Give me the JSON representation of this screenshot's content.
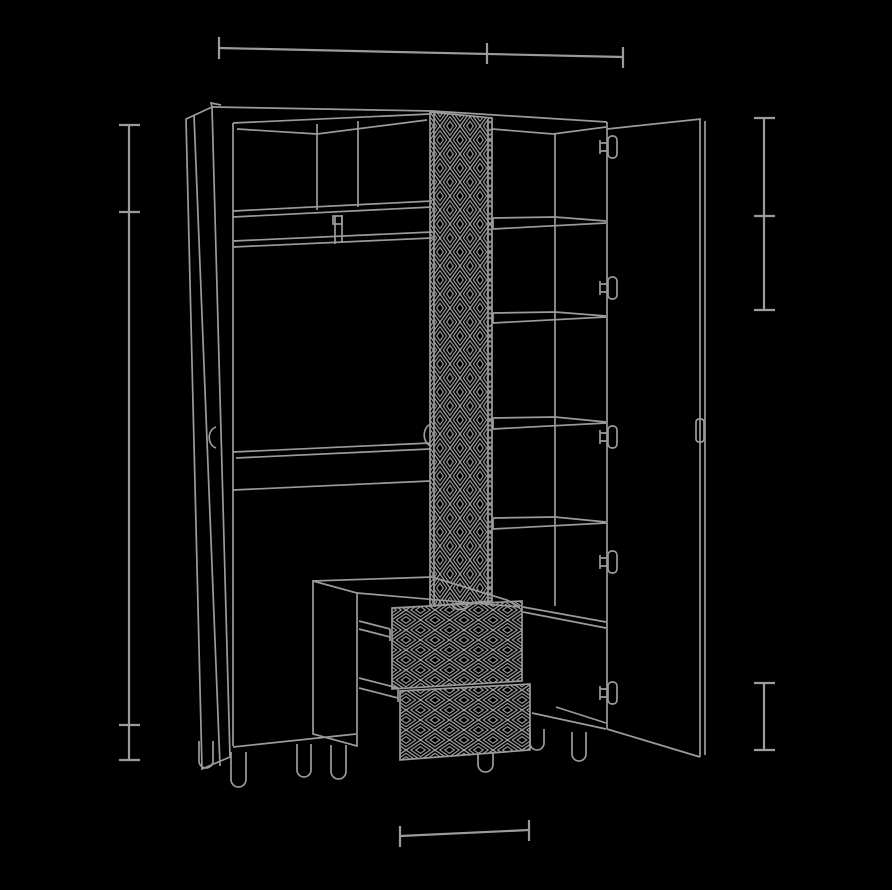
{
  "meta": {
    "title": "Wardrobe technical line drawing — perspective view with open right door and dimension lines (no numeric labels shown)"
  },
  "colors": {
    "background": "#000000",
    "line": "#9b9b9b"
  },
  "dimension_lines": {
    "top_width": {
      "orientation": "horizontal",
      "tick_count": 3,
      "text": ""
    },
    "left_height": {
      "orientation": "vertical",
      "tick_count": 4,
      "text": ""
    },
    "right_upper_height": {
      "orientation": "vertical",
      "tick_count": 3,
      "text": ""
    },
    "right_lower_leg_height": {
      "orientation": "vertical",
      "tick_count": 2,
      "text": ""
    },
    "bottom_drawer_width": {
      "orientation": "horizontal",
      "tick_count": 2,
      "text": ""
    }
  },
  "furniture": {
    "type": "wardrobe",
    "left_door": "closed hinged door seen edge-on with small curved handle and leg",
    "right_door": "open hinged door with five cup hinges and edge-mounted handle",
    "top_cubby_count": 3,
    "accessory_band_compartments": 2,
    "hanging_section": "open space with clothes rail",
    "shelf_count_right_column": 5,
    "drawer_count": 2,
    "center_panel_pattern": "dense nested tall diamonds",
    "drawer_front_pattern": "nested wide diamonds lattice",
    "leg_count": 7
  }
}
